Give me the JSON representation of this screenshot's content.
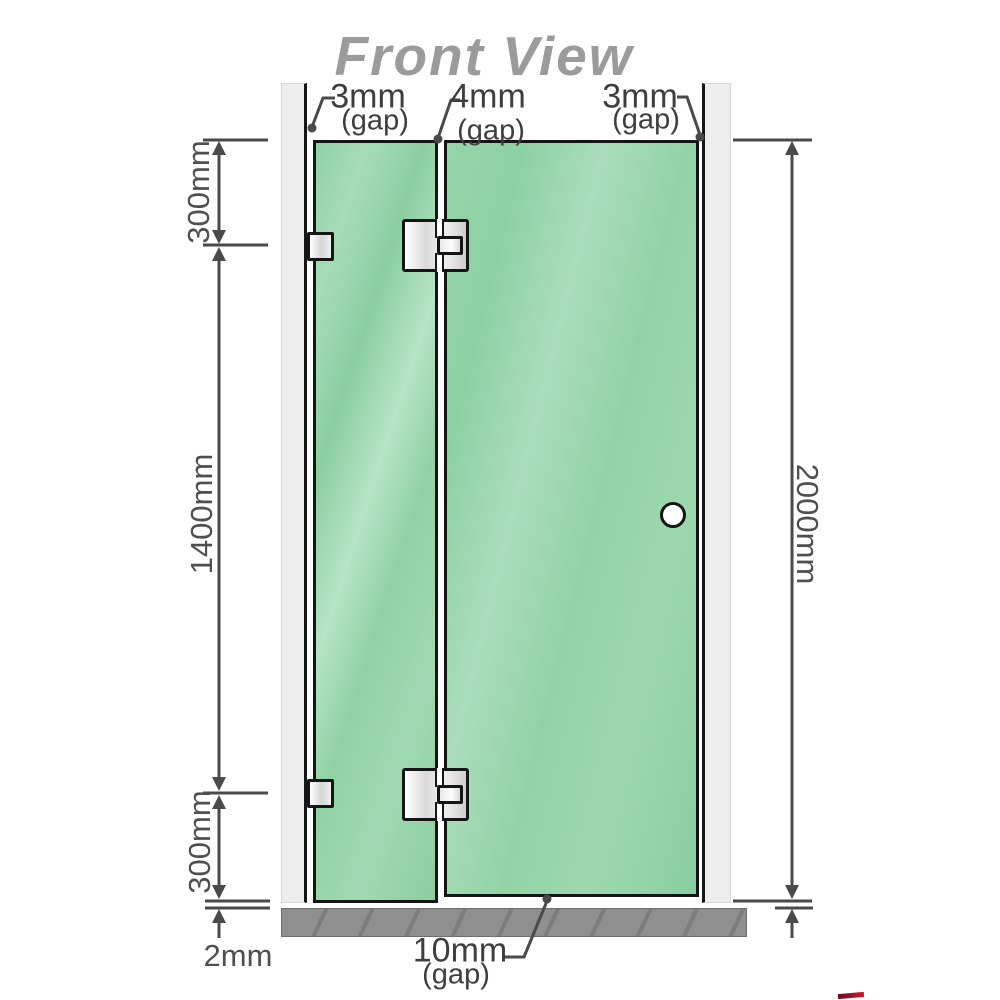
{
  "title": "Front View",
  "labels": {
    "left_gap_value": "3mm",
    "left_gap_qualifier": "(gap)",
    "middle_gap_value": "4mm",
    "middle_gap_qualifier": "(gap)",
    "right_gap_value": "3mm",
    "right_gap_qualifier": "(gap)",
    "bottom_gap_value": "10mm",
    "bottom_gap_qualifier": "(gap)",
    "floor_clearance": "2mm"
  },
  "dimensions": {
    "top_segment": "300mm",
    "middle_segment": "1400mm",
    "bottom_segment": "300mm",
    "overall_height": "2000mm"
  },
  "colors": {
    "glass_green": "#93d3a8",
    "wall_gray": "#ededed",
    "floor_gray": "#8f8f8f",
    "dimension_line": "#4a4a4a",
    "title_gray": "#9b9b9b",
    "watermark_red": "#c31432"
  }
}
